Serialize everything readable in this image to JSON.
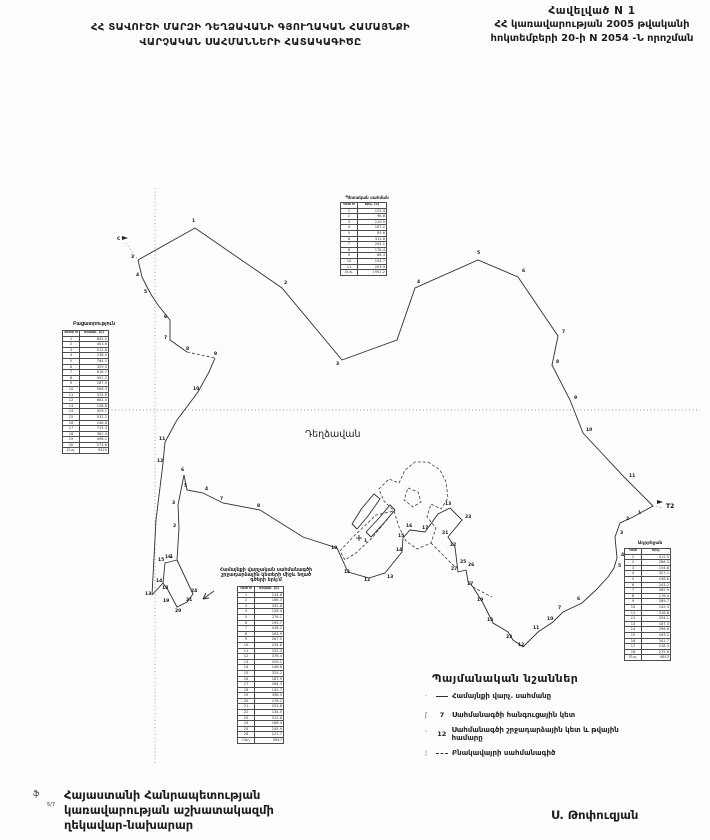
{
  "header": {
    "title_line1": "ՀՀ ՏԱՎՈՒՇԻ ՄԱՐԶԻ ԴԵՂՁԱՎԱՆԻ ԳՅՈՒՂԱԿԱՆ ՀԱՄԱՅՆՔԻ",
    "title_line2": "ՎԱՐՉԱԿԱՆ  ՍԱՀՄԱՆՆԵՐԻ  ՀԱՏԱԿԱԳԻԾԸ",
    "annex_line1": "Հավելված  N 1",
    "annex_line2": "ՀՀ կառավարության 2005 թվականի",
    "annex_line3": "հոկտեմբերի 20-ի N 2054 -Ն որոշման"
  },
  "map": {
    "settlement": {
      "text": "Դեղձավան",
      "x": 305,
      "y": 437
    },
    "graticule": [
      {
        "pts": "155,188 155,765"
      },
      {
        "pts": "108,410 700,410"
      }
    ],
    "boundary_lines": [
      {
        "style": "solid",
        "pts": "138,260 195,228 282,288 342,360 397,340 415,288 478,260 518,277 558,336 552,365 570,400 583,433 597,448 625,478 653,506"
      },
      {
        "style": "solid",
        "pts": "653,506 633,517 620,523 615,537 617,558 614,568 608,577 596,590 582,603 563,612 553,622 538,632 523,647"
      },
      {
        "style": "solid",
        "pts": "523,647 513,640 508,632 493,623 483,603 473,587 468,581 466,570 458,572 455,547 448,537 462,520 450,508 438,514 425,532 410,530 403,538 402,552 385,573 369,578 348,572 337,548 303,537 260,510 223,503 203,493 187,490 184,475"
      },
      {
        "style": "solid",
        "pts": "184,475 178,505 179,528 177,560"
      },
      {
        "style": "solid",
        "pts": "177,560 193,594 187,602 177,607 168,590 163,583 165,563 169,562 177,560"
      },
      {
        "style": "solid",
        "pts": "163,583 152,595"
      },
      {
        "style": "solid",
        "pts": "138,260 142,277 147,287 152,296 158,305 170,320 170,340 187,352"
      },
      {
        "style": "dash",
        "pts": "187,352 215,358"
      },
      {
        "style": "solid",
        "pts": "215,358 209,372 198,392 177,420 165,442 163,463 156,520 152,595"
      },
      {
        "style": "dot",
        "pts": "126,243 138,260"
      },
      {
        "style": "dot",
        "pts": "653,506 663,508"
      },
      {
        "style": "dash",
        "pts": "428,462 440,470 446,482 448,498 441,509 431,504 427,517 436,528 431,543 417,549 406,541 399,527 394,511 384,501 379,489 389,479 399,483 405,470 415,462 428,462"
      },
      {
        "style": "dash",
        "pts": "394,511 372,538 356,553 345,560 340,551 354,536 376,515 394,511"
      },
      {
        "style": "dash",
        "pts": "408,488 418,492 421,502 413,507 404,500 408,488"
      },
      {
        "style": "solid",
        "pts": "352,524 362,508 374,494 380,499 368,516 357,529 352,524"
      },
      {
        "style": "solid",
        "pts": "366,532 380,517 390,505 395,510 383,524 371,537 366,532"
      },
      {
        "style": "dash",
        "pts": "431,543 445,557 455,567"
      },
      {
        "style": "dash",
        "pts": "473,587 486,594 492,597"
      },
      {
        "style": "solid",
        "pts": "214,591 203,599"
      },
      {
        "style": "solid",
        "pts": "203,599 209,598"
      },
      {
        "style": "solid",
        "pts": "203,599 206,593"
      }
    ],
    "labels": [
      {
        "t": "1",
        "x": 192,
        "y": 222
      },
      {
        "t": "2",
        "x": 284,
        "y": 284
      },
      {
        "t": "3",
        "x": 336,
        "y": 365
      },
      {
        "t": "4",
        "x": 417,
        "y": 283
      },
      {
        "t": "5",
        "x": 477,
        "y": 254
      },
      {
        "t": "6",
        "x": 522,
        "y": 272
      },
      {
        "t": "7",
        "x": 562,
        "y": 333
      },
      {
        "t": "8",
        "x": 556,
        "y": 363
      },
      {
        "t": "9",
        "x": 574,
        "y": 399
      },
      {
        "t": "10",
        "x": 586,
        "y": 431
      },
      {
        "t": "11",
        "x": 629,
        "y": 477
      },
      {
        "t": "1",
        "x": 638,
        "y": 514
      },
      {
        "t": "2",
        "x": 626,
        "y": 520
      },
      {
        "t": "3",
        "x": 620,
        "y": 534
      },
      {
        "t": "4",
        "x": 621,
        "y": 556
      },
      {
        "t": "5",
        "x": 618,
        "y": 567
      },
      {
        "t": "6",
        "x": 577,
        "y": 600
      },
      {
        "t": "7",
        "x": 558,
        "y": 609
      },
      {
        "t": "10",
        "x": 547,
        "y": 620
      },
      {
        "t": "11",
        "x": 533,
        "y": 629
      },
      {
        "t": "12",
        "x": 518,
        "y": 646
      },
      {
        "t": "23",
        "x": 506,
        "y": 638
      },
      {
        "t": "15",
        "x": 487,
        "y": 621
      },
      {
        "t": "19",
        "x": 477,
        "y": 601
      },
      {
        "t": "17",
        "x": 467,
        "y": 585
      },
      {
        "t": "25",
        "x": 460,
        "y": 563
      },
      {
        "t": "26",
        "x": 468,
        "y": 566
      },
      {
        "t": "27",
        "x": 451,
        "y": 570
      },
      {
        "t": "22",
        "x": 450,
        "y": 546
      },
      {
        "t": "21",
        "x": 442,
        "y": 534
      },
      {
        "t": "23",
        "x": 465,
        "y": 518
      },
      {
        "t": "13",
        "x": 445,
        "y": 505
      },
      {
        "t": "17",
        "x": 422,
        "y": 529
      },
      {
        "t": "16",
        "x": 406,
        "y": 527
      },
      {
        "t": "15",
        "x": 398,
        "y": 537
      },
      {
        "t": "14",
        "x": 396,
        "y": 551
      },
      {
        "t": "13",
        "x": 387,
        "y": 578
      },
      {
        "t": "12",
        "x": 364,
        "y": 581
      },
      {
        "t": "11",
        "x": 344,
        "y": 573
      },
      {
        "t": "10",
        "x": 331,
        "y": 549
      },
      {
        "t": "8",
        "x": 257,
        "y": 507
      },
      {
        "t": "7",
        "x": 220,
        "y": 500
      },
      {
        "t": "4",
        "x": 205,
        "y": 490
      },
      {
        "t": "5",
        "x": 184,
        "y": 487
      },
      {
        "t": "6",
        "x": 181,
        "y": 471
      },
      {
        "t": "3",
        "x": 172,
        "y": 504
      },
      {
        "t": "2",
        "x": 173,
        "y": 527
      },
      {
        "t": "1",
        "x": 170,
        "y": 558
      },
      {
        "t": "3",
        "x": 131,
        "y": 258
      },
      {
        "t": "4",
        "x": 136,
        "y": 276
      },
      {
        "t": "5",
        "x": 144,
        "y": 293
      },
      {
        "t": "6",
        "x": 164,
        "y": 318
      },
      {
        "t": "7",
        "x": 164,
        "y": 339
      },
      {
        "t": "8",
        "x": 186,
        "y": 350
      },
      {
        "t": "9",
        "x": 214,
        "y": 355
      },
      {
        "t": "10",
        "x": 193,
        "y": 390
      },
      {
        "t": "11",
        "x": 159,
        "y": 440
      },
      {
        "t": "12",
        "x": 157,
        "y": 462
      },
      {
        "t": "13",
        "x": 145,
        "y": 595
      },
      {
        "t": "15",
        "x": 158,
        "y": 561
      },
      {
        "t": "16",
        "x": 165,
        "y": 558
      },
      {
        "t": "14",
        "x": 156,
        "y": 582
      },
      {
        "t": "18",
        "x": 162,
        "y": 589
      },
      {
        "t": "19",
        "x": 163,
        "y": 602
      },
      {
        "t": "20",
        "x": 175,
        "y": 612
      },
      {
        "t": "21",
        "x": 186,
        "y": 601
      },
      {
        "t": "24",
        "x": 191,
        "y": 592
      },
      {
        "t": "C",
        "x": 117,
        "y": 240
      },
      {
        "t": "1",
        "x": 364,
        "y": 542
      }
    ],
    "flags": [
      {
        "x": 122,
        "y": 236,
        "label": ""
      },
      {
        "x": 657,
        "y": 500,
        "label": "T2"
      }
    ],
    "cross": {
      "x": 359,
      "y": 538
    }
  },
  "tables": {
    "top": {
      "title": "Պետական սահման",
      "headers": [
        "Կետ N",
        "Երկ. (մ)"
      ],
      "rows": [
        [
          "1",
          "125.4"
        ],
        [
          "2",
          "96.8"
        ],
        [
          "3",
          "210.5"
        ],
        [
          "4",
          "187.2"
        ],
        [
          "5",
          "95.6"
        ],
        [
          "6",
          "312.8"
        ],
        [
          "7",
          "245.1"
        ],
        [
          "8",
          "178.4"
        ],
        [
          "9",
          "86.3"
        ],
        [
          "10",
          "154.7"
        ],
        [
          "11",
          "203.9"
        ],
        [
          "Ընդ.",
          "1951.2"
        ]
      ]
    },
    "left": {
      "title": "Բացատրություն",
      "headers": [
        "Կետի N",
        "Երկար. (մ)"
      ],
      "rows": [
        [
          "1",
          "845.2"
        ],
        [
          "2",
          "403.6"
        ],
        [
          "3",
          "512.8"
        ],
        [
          "4",
          "238.4"
        ],
        [
          "5",
          "764.1"
        ],
        [
          "6",
          "329.5"
        ],
        [
          "7",
          "618.7"
        ],
        [
          "8",
          "451.2"
        ],
        [
          "9",
          "287.9"
        ],
        [
          "10",
          "596.3"
        ],
        [
          "11",
          "374.8"
        ],
        [
          "12",
          "682.4"
        ],
        [
          "13",
          "158.6"
        ],
        [
          "14",
          "429.7"
        ],
        [
          "15",
          "531.2"
        ],
        [
          "16",
          "246.8"
        ],
        [
          "17",
          "715.3"
        ],
        [
          "18",
          "362.4"
        ],
        [
          "19",
          "498.1"
        ],
        [
          "20",
          "273.6"
        ],
        [
          "Ընդ.",
          "9320"
        ]
      ]
    },
    "middle": {
      "title1": "Համայնքի վարչական սահմանագծի",
      "title2": "շրջադարձային կետերի միջև եղած",
      "title3": "գծերի երկ/մ",
      "headers": [
        "Կետ N",
        "Երկար. (մ)"
      ],
      "rows": [
        [
          "1",
          "214.6"
        ],
        [
          "2",
          "186.3"
        ],
        [
          "3",
          "342.8"
        ],
        [
          "4",
          "128.4"
        ],
        [
          "5",
          "276.1"
        ],
        [
          "6",
          "195.7"
        ],
        [
          "7",
          "418.2"
        ],
        [
          "8",
          "163.9"
        ],
        [
          "9",
          "287.5"
        ],
        [
          "10",
          "234.8"
        ],
        [
          "11",
          "152.3"
        ],
        [
          "12",
          "376.4"
        ],
        [
          "13",
          "209.1"
        ],
        [
          "14",
          "148.6"
        ],
        [
          "15",
          "325.2"
        ],
        [
          "16",
          "187.9"
        ],
        [
          "17",
          "264.3"
        ],
        [
          "18",
          "142.7"
        ],
        [
          "19",
          "398.5"
        ],
        [
          "20",
          "176.2"
        ],
        [
          "21",
          "253.8"
        ],
        [
          "22",
          "134.5"
        ],
        [
          "23",
          "312.6"
        ],
        [
          "24",
          "168.4"
        ],
        [
          "25",
          "245.9"
        ],
        [
          "26",
          "121.7"
        ],
        [
          "Ընդ",
          "5847"
        ]
      ]
    },
    "right": {
      "title": "Ադրբեջան",
      "headers": [
        "Կետ",
        "Երկ."
      ],
      "rows": [
        [
          "1",
          "412.5"
        ],
        [
          "2",
          "286.3"
        ],
        [
          "3",
          "154.8"
        ],
        [
          "4",
          "327.1"
        ],
        [
          "5",
          "198.6"
        ],
        [
          "6",
          "243.2"
        ],
        [
          "7",
          "365.9"
        ],
        [
          "8",
          "176.4"
        ],
        [
          "9",
          "289.7"
        ],
        [
          "10",
          "142.3"
        ],
        [
          "11",
          "318.6"
        ],
        [
          "12",
          "254.1"
        ],
        [
          "13",
          "187.5"
        ],
        [
          "14",
          "296.8"
        ],
        [
          "15",
          "163.2"
        ],
        [
          "16",
          "341.7"
        ],
        [
          "17",
          "218.4"
        ],
        [
          "18",
          "275.6"
        ],
        [
          "Ընդ.",
          "4653"
        ]
      ]
    }
  },
  "legend": {
    "title": "Պայմանական  նշաններ",
    "items": [
      {
        "tick": "·",
        "num": "",
        "label": "Համայնքի վարչ. սահմանը"
      },
      {
        "tick": "ʃ",
        "num": "7",
        "label": "Սահմանագծի հանգուցային կետ"
      },
      {
        "tick": "՝",
        "num": "12",
        "label": "Սահմանագծի շրջադարձային կետ և թվային համարը"
      },
      {
        "tick": "¦",
        "num": "",
        "label": "Բնակավայրի սահմանագիծ"
      }
    ]
  },
  "footer": {
    "line1": "Հայաստանի Հանրապետության",
    "line2": "կառավարության աշխատակազմի",
    "line3": "ղեկավար-նախարար",
    "signer": "Ս. Թոփուզյան",
    "mark1": "ֆ",
    "mark2": "5/7"
  }
}
